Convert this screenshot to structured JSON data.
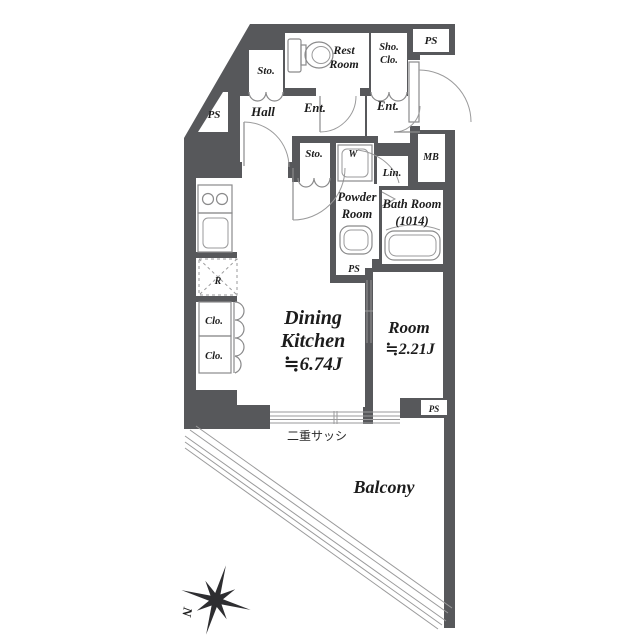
{
  "plan_type": "apartment-floor-plan",
  "colors": {
    "wall": "#57585b",
    "fixture_line": "#8a8a8b",
    "text": "#1c1c1c"
  },
  "labels": {
    "ps_top_right": "PS",
    "rest_room": [
      "Rest",
      "Room"
    ],
    "sto_top": "Sto.",
    "sho_clo": [
      "Sho.",
      "Clo."
    ],
    "ps_left": "PS",
    "hall": "Hall",
    "ent_inner": "Ent.",
    "ent_outer": "Ent.",
    "mb": "MB",
    "sto_mid": "Sto.",
    "washer": "W",
    "lin": "Lin.",
    "powder_room": [
      "Powder",
      "Room"
    ],
    "bath_room": [
      "Bath Room",
      "(1014)"
    ],
    "ps_powder": "PS",
    "fridge": "R",
    "clo_upper": "Clo.",
    "clo_lower": "Clo.",
    "dining_kitchen": [
      "Dining",
      "Kitchen",
      "≒6.74J"
    ],
    "room": [
      "Room",
      "≒2.21J"
    ],
    "ps_room": "PS",
    "double_sash_note": "二重サッシ",
    "balcony": "Balcony",
    "compass_north": "N"
  }
}
